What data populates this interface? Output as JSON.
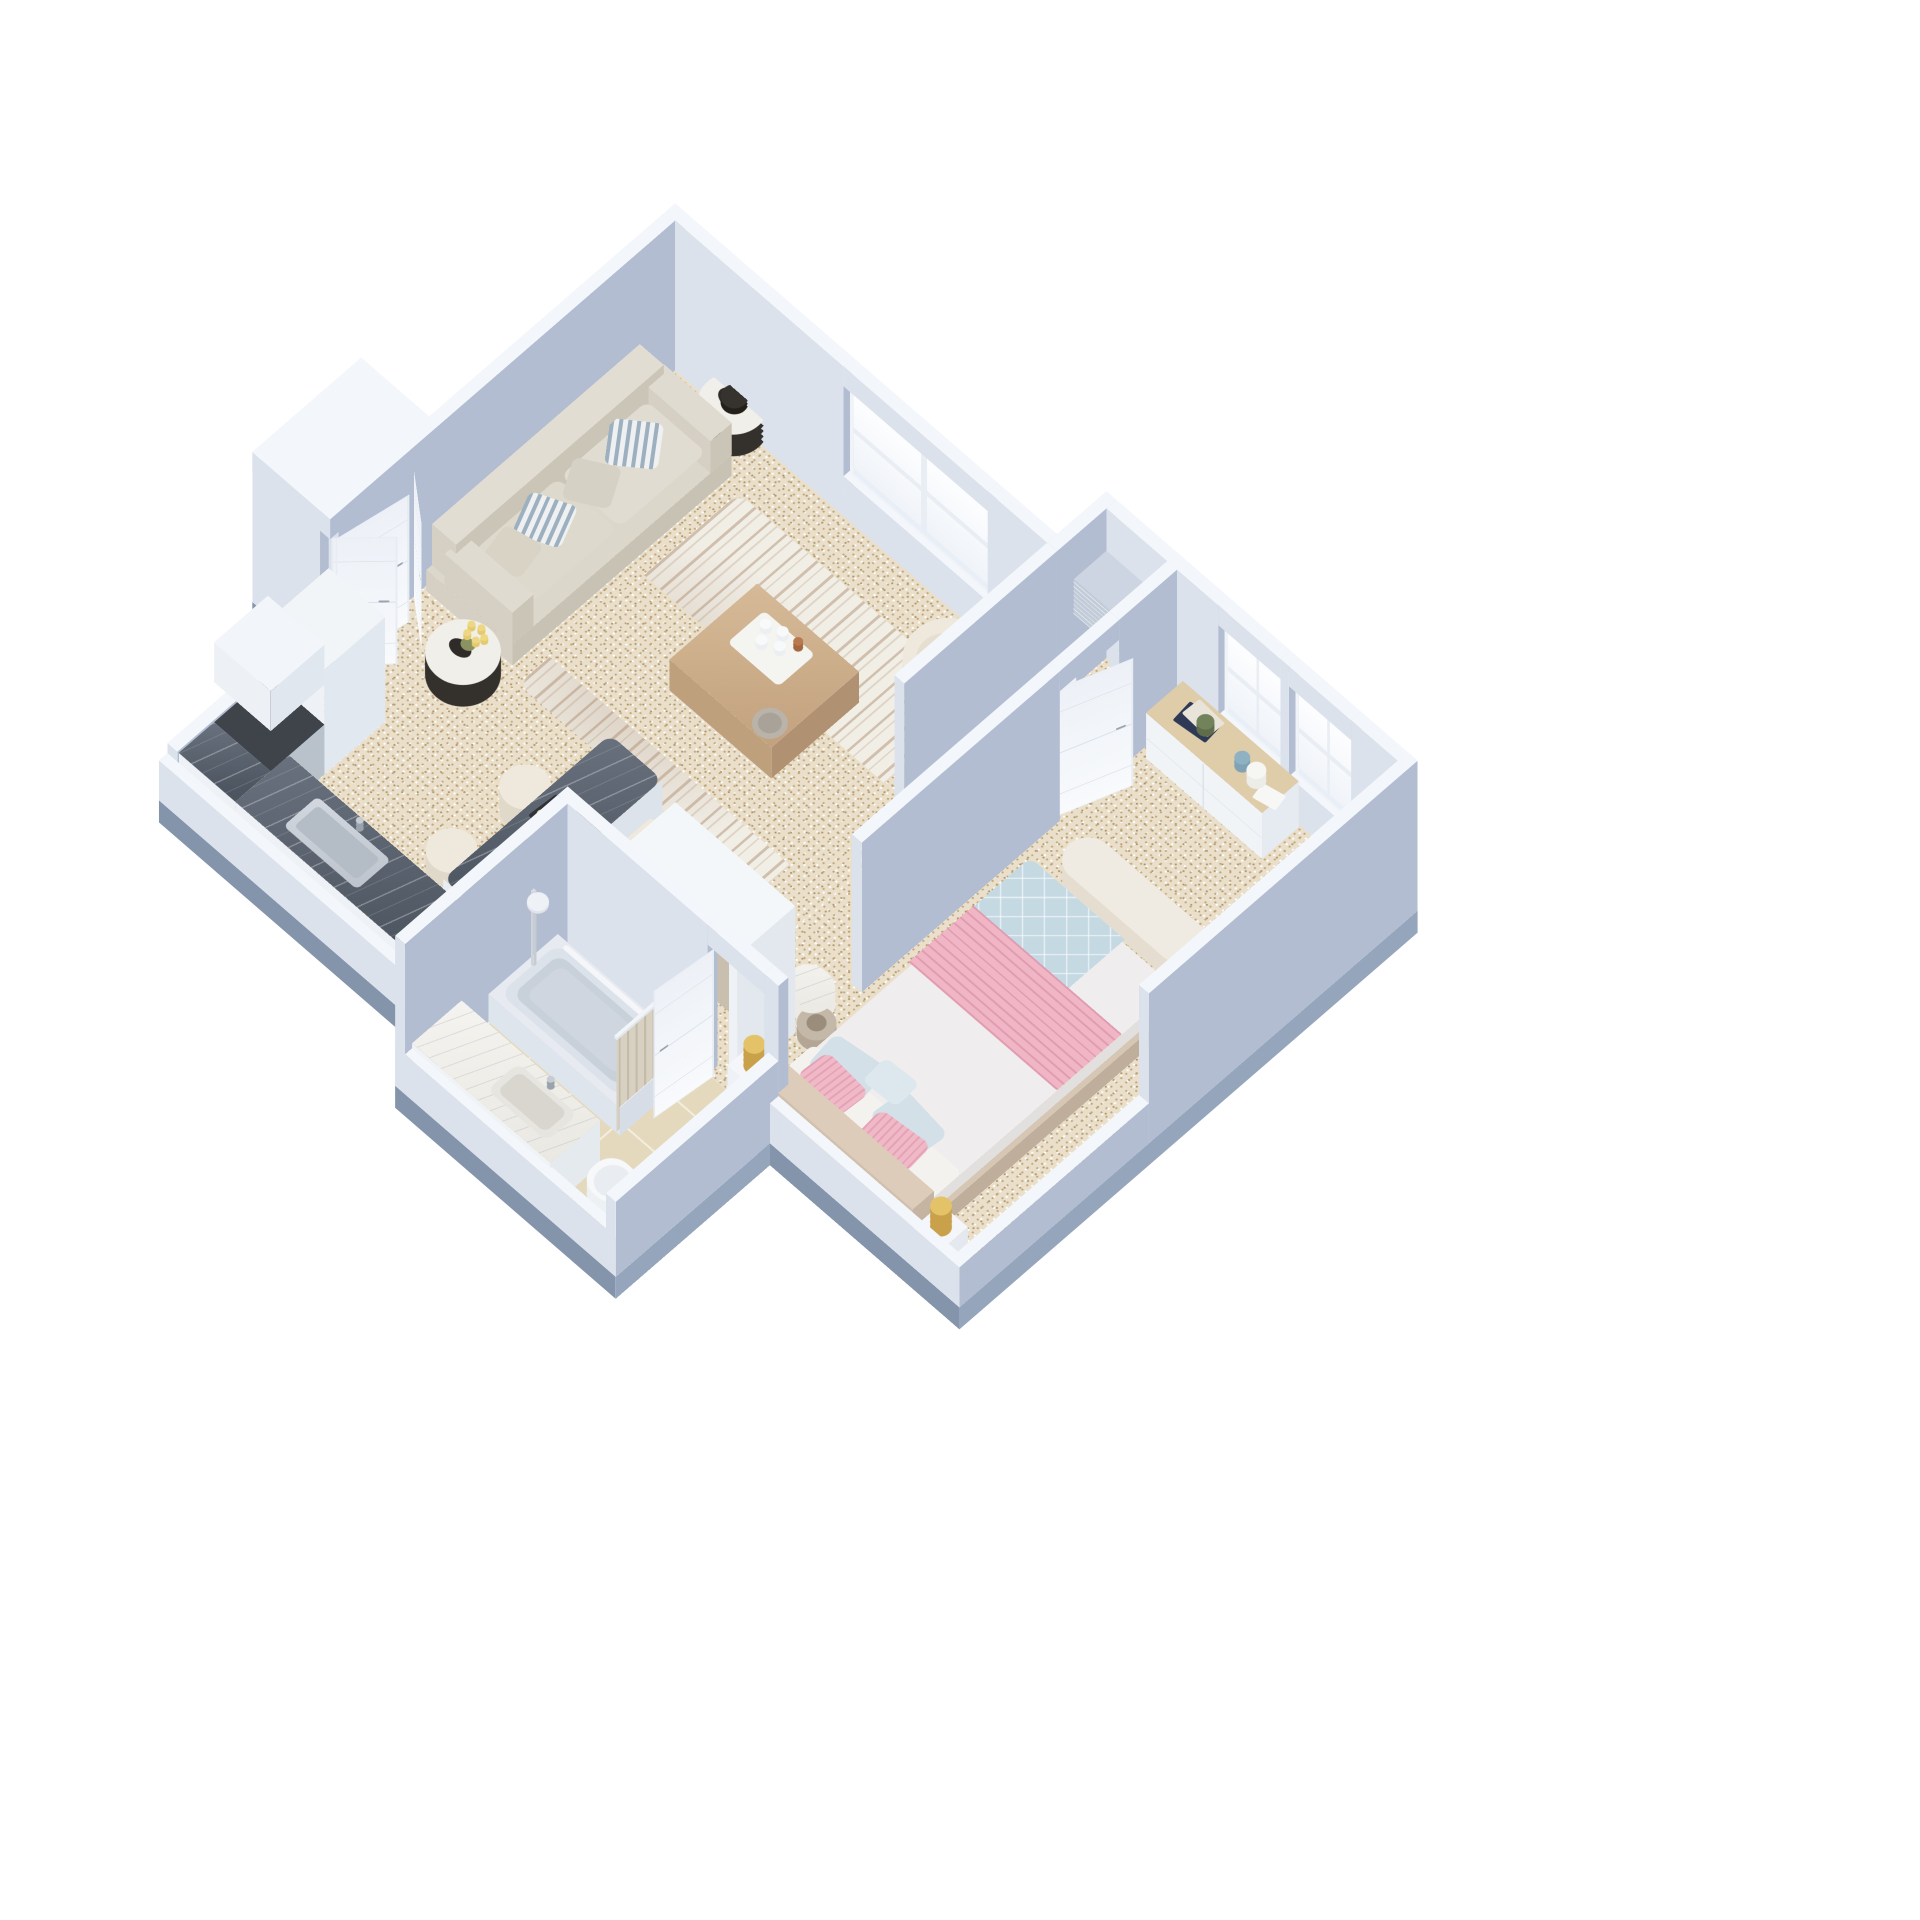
{
  "scene": {
    "type": "isometric-3d-floorplan-render",
    "style": "dollhouse cutaway, one-bedroom apartment, no text labels",
    "background": "#ffffff"
  },
  "palette": {
    "background": "#ffffff",
    "wallFaceLight": "#dbe2ec",
    "wallFaceMedium": "#b2bdd1",
    "wallTop": "#f3f6fa",
    "slabSouth": "#8494ab",
    "slabEast": "#95a5bc",
    "floorBase": "#e9dfca",
    "floorDotTan": "#c2a678",
    "floorDotBrown": "#a98f66",
    "tileBase": "#e4d9bd",
    "tileGrout": "#f3eedd",
    "marbleDarkA": "#68717d",
    "marbleDarkB": "#4d5561",
    "marbleWhiteA": "#f5f3ef",
    "marbleWhiteB": "#eae8e2",
    "counterCabinet": "#eef1f6",
    "applianceSteel": "#b9c1ca",
    "stoveTop": "#3f444b",
    "woodCoffeeA": "#d6ba97",
    "woodCoffeeB": "#c2a17e",
    "woodDresserTop": "#dfcca9",
    "sofaBody": "#d5d0c3",
    "sofaSeat": "#e1dcd1",
    "pillowStripeBlue": "#9db0c0",
    "armchairCream": "#e7e0d2",
    "rugBase": "#f1eee6",
    "rugStripe": "#b6997f",
    "drumDark": "#34302c",
    "drumTop": "#f1efe9",
    "quiltBlue": "#c5d9e3",
    "runnerPink": "#f0b6c5",
    "runnerLine": "#e09cb0",
    "pillowBlue": "#d3e0e8",
    "pillowPinkA": "#f0b9c7",
    "pillowPinkB": "#e5a2b4",
    "bedBaseSide": "#c9b7a5",
    "headboard": "#d0c0ad",
    "mattress": "#efeded",
    "lampGold": "#c9a14b",
    "lampGoldLight": "#e3c268",
    "doorWhite": "#f7f9fc",
    "doorLine": "#dde3ea",
    "glassTint": "#dee6f2",
    "curtainBeige": "#d8d1c2",
    "curtainLine": "#c4bcab",
    "garmentA": "#d9d0c1",
    "garmentB": "#cfc5b4",
    "garmentC": "#e3dccd",
    "garmentD": "#c8bfae",
    "garmentE": "#ded5c6",
    "tubRim": "#e7ebf1",
    "tubBasin": "#c8d0da",
    "porcelain": "#f4f6f9",
    "basketTaupe": "#b3a695",
    "plantGreen": "#5f6d4a",
    "vaseBlue": "#7fa3b5",
    "bookNavy": "#2e3a55",
    "tulipYellow": "#e4c96f",
    "stemGreen": "#8a9262",
    "acCabinet": "#c2ccd9",
    "steelFixture": "#c6ccd4"
  },
  "rooms": [
    {
      "name": "living-room",
      "furniture": [
        "sofa",
        "striped-pillows",
        "drum-table-north",
        "drum-table-south",
        "decor-bowl",
        "tulip-bouquet",
        "living-rug",
        "coffee-table",
        "coffee-tray",
        "armchair",
        "window-living"
      ]
    },
    {
      "name": "kitchen",
      "furniture": [
        "fridge",
        "stove",
        "kitchen-wall-cabinet",
        "kitchen-counter",
        "kitchen-sink",
        "kitchen-faucet"
      ]
    },
    {
      "name": "dining-area",
      "furniture": [
        "dining-table",
        "stools",
        "tablet",
        "tulip-vase"
      ]
    },
    {
      "name": "entry-nook",
      "furniture": [
        "console-table",
        "console-vases",
        "ac-cabinet",
        "entry-closet",
        "closet-doors",
        "entry-door"
      ]
    },
    {
      "name": "hall",
      "furniture": [
        "wardrobe",
        "wardrobe-garments",
        "bedroom-door",
        "bathroom-door"
      ]
    },
    {
      "name": "bedroom",
      "furniture": [
        "bed",
        "quilt",
        "runner",
        "pillows",
        "headboard",
        "nightstands",
        "gold-lamps",
        "bench-bolster",
        "dresser",
        "books",
        "plant",
        "vases",
        "laundry-basket",
        "side-table-marble",
        "windows-bedroom"
      ]
    },
    {
      "name": "bathroom",
      "furniture": [
        "bathtub",
        "shower-head",
        "shower-curtain",
        "curtain-rod",
        "vanity",
        "vanity-sink",
        "toilet",
        "tile-floor"
      ]
    }
  ]
}
